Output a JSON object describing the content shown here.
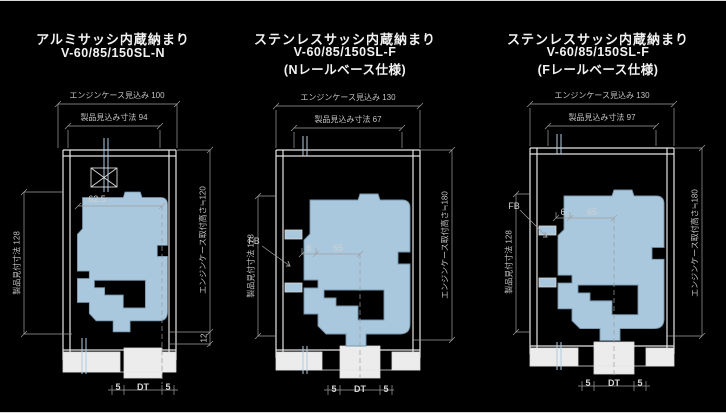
{
  "drawing": {
    "background": "#000000",
    "line_color": "#e8e8e8",
    "dim_color": "#c3c3c3",
    "section_fill": "#a9c7dd",
    "glass_color": "#aeccdf",
    "diagrams": [
      {
        "title_line1": "アルミサッシ内蔵納まり",
        "title_line2": "V-60/85/150SL-N",
        "title_line3": "",
        "dim_case_depth": "エンジンケース見込み 100",
        "dim_product_depth": "製品見込み寸法 94",
        "dim_product_face": "製品見付寸法 128",
        "dim_case_height": "エンジンケース取付高さ≒120",
        "dim_inner": "62.5",
        "dim_offset": "12",
        "dim_sill_left": "5",
        "dim_sill_center": "DT",
        "dim_sill_right": "5"
      },
      {
        "title_line1": "ステンレスサッシ内蔵納まり",
        "title_line2": "V-60/85/150SL-F",
        "title_line3": "(Nレールベース仕様)",
        "dim_case_depth": "エンジンケース見込み 130",
        "dim_product_depth": "製品見込み寸法 67",
        "dim_product_face": "製品見付寸法 128",
        "dim_case_height": "エンジンケース取付高さ≒180",
        "label_fb": "FB",
        "dim_gap": "6",
        "dim_inner": "65",
        "dim_sill_left": "5",
        "dim_sill_center": "DT",
        "dim_sill_right": "5"
      },
      {
        "title_line1": "ステンレスサッシ内蔵納まり",
        "title_line2": "V-60/85/150SL-F",
        "title_line3": "(Fレールベース仕様)",
        "dim_case_depth": "エンジンケース見込み 130",
        "dim_product_depth": "製品見込み寸法 97",
        "dim_product_face": "製品見付寸法 128",
        "dim_case_height": "エンジンケース取付高さ≒180",
        "label_fb": "FB",
        "dim_gap": "6",
        "dim_inner": "65",
        "dim_sill_left": "5",
        "dim_sill_center": "DT",
        "dim_sill_right": "5"
      }
    ]
  }
}
